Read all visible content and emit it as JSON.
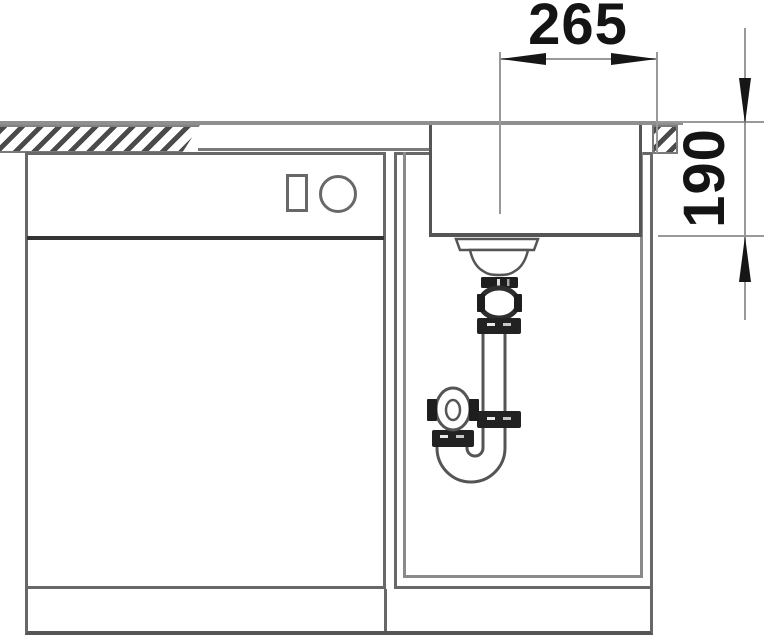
{
  "diagram": {
    "type": "technical-drawing",
    "subject": "kitchen-sink-cabinet-section-with-siphon",
    "dimensions": {
      "bowl_center_to_edge": "265",
      "bowl_depth": "190"
    }
  },
  "colors": {
    "cabinet_line": "#686868",
    "counter_line": "#8f8f8f",
    "dark_fitting": "#1e1e1e",
    "dimension_line": "#999999",
    "dimension_text": "#141414"
  }
}
